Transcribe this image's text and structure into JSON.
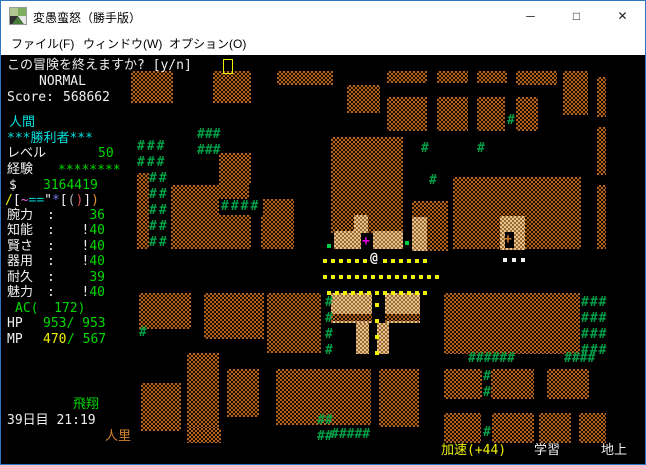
{
  "window": {
    "title": "変愚蛮怒（勝手版）",
    "minimize": "─",
    "maximize": "□",
    "close": "✕"
  },
  "menu": {
    "items": [
      {
        "label": "ファイル(F)"
      },
      {
        "label": "ウィンドウ(W)"
      },
      {
        "label": "オプション(O)"
      }
    ]
  },
  "hud": {
    "message": "この冒険を終えますか? [y/n]",
    "mode": "NORMAL",
    "score_label": "Score:",
    "score_value": "568662",
    "race": "人間",
    "title_line": "***勝利者***",
    "level_label": "レベル",
    "level_value": "50",
    "exp_label": "経験",
    "exp_value": "********",
    "gold_symbol": "$",
    "gold_value": "3164419",
    "equipment": [
      {
        "ch": "/",
        "c": "#f0f000"
      },
      {
        "ch": "[",
        "c": "#f0f0f0"
      },
      {
        "ch": "~",
        "c": "#e060e0"
      },
      {
        "ch": "=",
        "c": "#00c8c8"
      },
      {
        "ch": "=",
        "c": "#00c8c8"
      },
      {
        "ch": "\"",
        "c": "#f0f0f0"
      },
      {
        "ch": "*",
        "c": "#7878f0"
      },
      {
        "ch": "[",
        "c": "#f0f0f0"
      },
      {
        "ch": "(",
        "c": "#b0b0b0"
      },
      {
        "ch": ")",
        "c": "#e05050"
      },
      {
        "ch": "]",
        "c": "#f0f0f0"
      },
      {
        "ch": ")",
        "c": "#e09030"
      }
    ],
    "stats": [
      {
        "label": "腕力",
        "colon": ":",
        "prefix": "",
        "value": "36"
      },
      {
        "label": "知能",
        "colon": ":",
        "prefix": "!",
        "value": "40"
      },
      {
        "label": "賢さ",
        "colon": ":",
        "prefix": "!",
        "value": "40"
      },
      {
        "label": "器用",
        "colon": ":",
        "prefix": "!",
        "value": "40"
      },
      {
        "label": "耐久",
        "colon": ":",
        "prefix": "",
        "value": "39"
      },
      {
        "label": "魅力",
        "colon": ":",
        "prefix": "!",
        "value": "40"
      }
    ],
    "ac_line": "AC(  172)",
    "hp_label": "HP",
    "hp_value": "953/ 953",
    "mp_label": "MP",
    "mp_cur": "470",
    "mp_rest": "/ 567",
    "status_flight": "飛翔",
    "date_time": "39日目 21:19",
    "location": "人里",
    "haste": "加速(+44)",
    "learning": "学習",
    "depth": "地上"
  },
  "map": {
    "walls": [
      {
        "x": 130,
        "y": 70,
        "w": 42,
        "h": 32
      },
      {
        "x": 212,
        "y": 70,
        "w": 38,
        "h": 32
      },
      {
        "x": 276,
        "y": 70,
        "w": 56,
        "h": 14
      },
      {
        "x": 346,
        "y": 84,
        "w": 33,
        "h": 28
      },
      {
        "x": 386,
        "y": 70,
        "w": 40,
        "h": 12
      },
      {
        "x": 436,
        "y": 70,
        "w": 31,
        "h": 12
      },
      {
        "x": 476,
        "y": 70,
        "w": 30,
        "h": 12
      },
      {
        "x": 515,
        "y": 70,
        "w": 41,
        "h": 14
      },
      {
        "x": 562,
        "y": 70,
        "w": 25,
        "h": 44
      },
      {
        "x": 596,
        "y": 76,
        "w": 9,
        "h": 40
      },
      {
        "x": 596,
        "y": 126,
        "w": 9,
        "h": 48
      },
      {
        "x": 596,
        "y": 184,
        "w": 9,
        "h": 64
      },
      {
        "x": 386,
        "y": 96,
        "w": 40,
        "h": 34
      },
      {
        "x": 436,
        "y": 96,
        "w": 31,
        "h": 34
      },
      {
        "x": 476,
        "y": 96,
        "w": 28,
        "h": 34
      },
      {
        "x": 515,
        "y": 96,
        "w": 22,
        "h": 34
      },
      {
        "x": 330,
        "y": 136,
        "w": 72,
        "h": 96
      },
      {
        "x": 218,
        "y": 152,
        "w": 32,
        "h": 32
      },
      {
        "x": 170,
        "y": 184,
        "w": 80,
        "h": 64
      },
      {
        "x": 260,
        "y": 198,
        "w": 33,
        "h": 50
      },
      {
        "x": 411,
        "y": 200,
        "w": 36,
        "h": 50
      },
      {
        "x": 452,
        "y": 176,
        "w": 128,
        "h": 72
      },
      {
        "x": 136,
        "y": 172,
        "w": 12,
        "h": 76
      },
      {
        "x": 138,
        "y": 292,
        "w": 52,
        "h": 36
      },
      {
        "x": 203,
        "y": 292,
        "w": 60,
        "h": 46
      },
      {
        "x": 266,
        "y": 292,
        "w": 54,
        "h": 60
      },
      {
        "x": 443,
        "y": 292,
        "w": 136,
        "h": 61
      },
      {
        "x": 275,
        "y": 368,
        "w": 95,
        "h": 56
      },
      {
        "x": 378,
        "y": 368,
        "w": 40,
        "h": 58
      },
      {
        "x": 443,
        "y": 368,
        "w": 38,
        "h": 30
      },
      {
        "x": 490,
        "y": 368,
        "w": 43,
        "h": 30
      },
      {
        "x": 546,
        "y": 368,
        "w": 42,
        "h": 30
      },
      {
        "x": 443,
        "y": 412,
        "w": 37,
        "h": 30
      },
      {
        "x": 491,
        "y": 412,
        "w": 42,
        "h": 30
      },
      {
        "x": 538,
        "y": 412,
        "w": 32,
        "h": 30
      },
      {
        "x": 578,
        "y": 412,
        "w": 27,
        "h": 30
      },
      {
        "x": 186,
        "y": 352,
        "w": 32,
        "h": 76
      },
      {
        "x": 140,
        "y": 382,
        "w": 40,
        "h": 48
      },
      {
        "x": 226,
        "y": 368,
        "w": 32,
        "h": 48
      },
      {
        "x": 186,
        "y": 427,
        "w": 34,
        "h": 15
      },
      {
        "x": 333,
        "y": 230,
        "w": 27,
        "h": 18,
        "lit": true
      },
      {
        "x": 372,
        "y": 230,
        "w": 30,
        "h": 18,
        "lit": true
      },
      {
        "x": 353,
        "y": 214,
        "w": 14,
        "h": 18,
        "lit": true
      },
      {
        "x": 499,
        "y": 215,
        "w": 25,
        "h": 34,
        "lit": true
      },
      {
        "x": 411,
        "y": 216,
        "w": 15,
        "h": 34,
        "lit": true
      },
      {
        "x": 386,
        "y": 232,
        "w": 16,
        "h": 16,
        "lit": true
      },
      {
        "x": 330,
        "y": 292,
        "w": 41,
        "h": 30,
        "lit": true
      },
      {
        "x": 384,
        "y": 292,
        "w": 35,
        "h": 30,
        "lit": true
      },
      {
        "x": 355,
        "y": 322,
        "w": 13,
        "h": 31,
        "lit": true
      },
      {
        "x": 376,
        "y": 322,
        "w": 12,
        "h": 31,
        "lit": true
      },
      {
        "x": 330,
        "y": 313,
        "w": 41,
        "h": 7
      },
      {
        "x": 384,
        "y": 313,
        "w": 35,
        "h": 7
      },
      {
        "x": 248,
        "y": 184,
        "w": 14,
        "h": 15,
        "blk": true
      },
      {
        "x": 218,
        "y": 198,
        "w": 44,
        "h": 16,
        "blk": true
      },
      {
        "x": 504,
        "y": 231,
        "w": 9,
        "h": 16,
        "blk": true
      }
    ],
    "glyphs": [
      {
        "t": "###",
        "x": 136,
        "y": 138,
        "c": "#00a048",
        "ls": 2
      },
      {
        "t": "###",
        "x": 136,
        "y": 154,
        "c": "#00a048",
        "ls": 2
      },
      {
        "t": "##",
        "x": 148,
        "y": 170,
        "c": "#00a048",
        "ls": 2
      },
      {
        "t": "##",
        "x": 148,
        "y": 186,
        "c": "#00a048",
        "ls": 2
      },
      {
        "t": "##",
        "x": 148,
        "y": 202,
        "c": "#00a048",
        "ls": 2
      },
      {
        "t": "##",
        "x": 148,
        "y": 218,
        "c": "#00a048",
        "ls": 2
      },
      {
        "t": "##",
        "x": 148,
        "y": 234,
        "c": "#00a048",
        "ls": 2
      },
      {
        "t": "###",
        "x": 196,
        "y": 126,
        "c": "#00a048",
        "ls": 0
      },
      {
        "t": "###",
        "x": 196,
        "y": 142,
        "c": "#00a048",
        "ls": 0
      },
      {
        "t": "####",
        "x": 220,
        "y": 198,
        "c": "#00a048",
        "ls": 2
      },
      {
        "t": "#",
        "x": 420,
        "y": 140,
        "c": "#00a048",
        "ls": 0
      },
      {
        "t": "#",
        "x": 476,
        "y": 140,
        "c": "#00a048",
        "ls": 0
      },
      {
        "t": "#",
        "x": 428,
        "y": 172,
        "c": "#00a048",
        "ls": 0
      },
      {
        "t": "#",
        "x": 506,
        "y": 112,
        "c": "#00a048",
        "ls": 0
      },
      {
        "t": "###",
        "x": 580,
        "y": 294,
        "c": "#00a048",
        "ls": 1
      },
      {
        "t": "###",
        "x": 580,
        "y": 310,
        "c": "#00a048",
        "ls": 1
      },
      {
        "t": "###",
        "x": 580,
        "y": 326,
        "c": "#00a048",
        "ls": 1
      },
      {
        "t": "###",
        "x": 580,
        "y": 342,
        "c": "#00a048",
        "ls": 1
      },
      {
        "t": "#",
        "x": 324,
        "y": 294,
        "c": "#00a048",
        "ls": 0
      },
      {
        "t": "#",
        "x": 324,
        "y": 310,
        "c": "#00a048",
        "ls": 0
      },
      {
        "t": "#",
        "x": 324,
        "y": 326,
        "c": "#00a048",
        "ls": 0
      },
      {
        "t": "#",
        "x": 324,
        "y": 342,
        "c": "#00a048",
        "ls": 0
      },
      {
        "t": "##",
        "x": 316,
        "y": 412,
        "c": "#00a048",
        "ls": 0
      },
      {
        "t": "##",
        "x": 316,
        "y": 428,
        "c": "#00a048",
        "ls": 0
      },
      {
        "t": "#",
        "x": 138,
        "y": 324,
        "c": "#00a048",
        "ls": 0
      },
      {
        "t": "######",
        "x": 467,
        "y": 350,
        "c": "#00a048",
        "ls": 0
      },
      {
        "t": "####",
        "x": 563,
        "y": 350,
        "c": "#00a048",
        "ls": 0
      },
      {
        "t": "#",
        "x": 482,
        "y": 368,
        "c": "#00a048",
        "ls": 0
      },
      {
        "t": "#",
        "x": 482,
        "y": 384,
        "c": "#00a048",
        "ls": 0
      },
      {
        "t": "#",
        "x": 482,
        "y": 424,
        "c": "#00a048",
        "ls": 0
      },
      {
        "t": "#####",
        "x": 330,
        "y": 426,
        "c": "#00a048",
        "ls": 0
      },
      {
        "t": "@",
        "x": 369,
        "y": 250,
        "c": "#f0f0f0",
        "ls": 0,
        "n": "player-glyph"
      },
      {
        "t": "+",
        "x": 361,
        "y": 233,
        "c": "#f000f0",
        "ls": 0,
        "n": "door-glyph"
      },
      {
        "t": "+",
        "x": 503,
        "y": 231,
        "c": "#c87828",
        "ls": 0,
        "n": "door-glyph"
      }
    ],
    "dots": [
      {
        "x": 322,
        "y": 258,
        "n": 6,
        "dx": 8,
        "dy": 0,
        "c": "#f0f000"
      },
      {
        "x": 382,
        "y": 258,
        "n": 6,
        "dx": 8,
        "dy": 0,
        "c": "#f0f000"
      },
      {
        "x": 322,
        "y": 274,
        "n": 15,
        "dx": 8,
        "dy": 0,
        "c": "#f0f000"
      },
      {
        "x": 326,
        "y": 290,
        "n": 13,
        "dx": 8,
        "dy": 0,
        "c": "#f0f000"
      },
      {
        "x": 374,
        "y": 302,
        "n": 4,
        "dx": 0,
        "dy": 16,
        "c": "#f0f000"
      },
      {
        "x": 502,
        "y": 257,
        "n": 3,
        "dx": 9,
        "dy": 0,
        "c": "#f0f0f0"
      },
      {
        "x": 326,
        "y": 243,
        "n": 1,
        "dx": 0,
        "dy": 0,
        "c": "#00cc44"
      },
      {
        "x": 404,
        "y": 240,
        "n": 1,
        "dx": 0,
        "dy": 0,
        "c": "#00cc44"
      }
    ]
  }
}
